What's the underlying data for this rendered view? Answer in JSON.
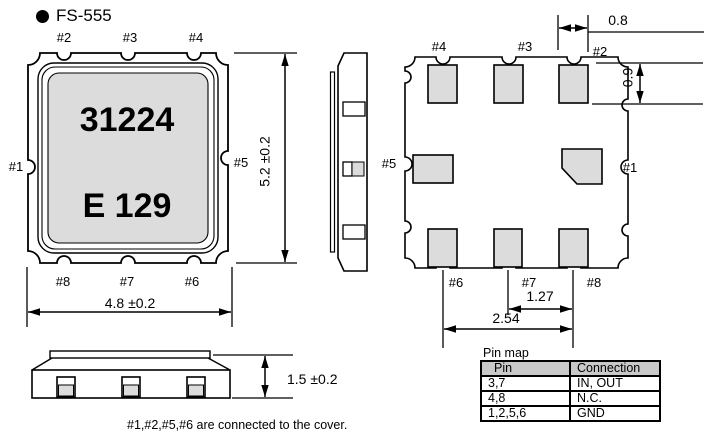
{
  "title": "FS-555",
  "top_view": {
    "marking_line1": "31224",
    "marking_line2": "E 129",
    "pin_labels": {
      "p1": "#1",
      "p2": "#2",
      "p3": "#3",
      "p4": "#4",
      "p5": "#5",
      "p6": "#6",
      "p7": "#7",
      "p8": "#8"
    },
    "dim_width": "4.8 ±0.2",
    "dim_height": "5.2 ±0.2"
  },
  "bottom_view": {
    "pin_labels": {
      "p1": "#1",
      "p2": "#2",
      "p3": "#3",
      "p4": "#4",
      "p5": "#5",
      "p6": "#6",
      "p7": "#7",
      "p8": "#8"
    },
    "dims": {
      "pad_width": "0.8",
      "pad_height": "0.9",
      "pitch": "1.27",
      "span": "2.54"
    }
  },
  "side_profile": {
    "dim_height": "1.5 ±0.2"
  },
  "note": "#1,#2,#5,#6 are connected to the cover.",
  "pin_map": {
    "caption": "Pin map",
    "columns": [
      "Pin",
      "Connection"
    ],
    "rows": [
      {
        "pin": "3,7",
        "connection": "IN, OUT"
      },
      {
        "pin": "4,8",
        "connection": "N.C."
      },
      {
        "pin": "1,2,5,6",
        "connection": "GND"
      }
    ]
  },
  "colors": {
    "line": "#000000",
    "pad_fill": "#dcdcdc",
    "header_fill": "#c9c9c9",
    "background": "#ffffff"
  }
}
